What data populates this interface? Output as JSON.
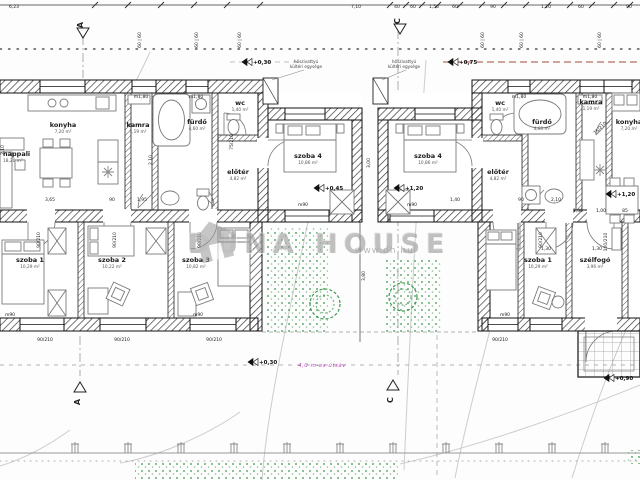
{
  "watermark": {
    "brand": "DUNA HOUSE",
    "url": "www.dh.hu"
  },
  "notes": {
    "road_note": "4,0 m-es útsáv",
    "heat_pump_lines": [
      "hőszivattyú",
      "kültéri egysége"
    ],
    "heat_pump_positions": [
      {
        "x": 306,
        "y": 63
      },
      {
        "x": 404,
        "y": 63
      }
    ]
  },
  "colors": {
    "wall_edge": "#101010",
    "hatch": "#3a3a3a",
    "thin_line": "#777777",
    "dim_text": "#222222",
    "green": "#3f9a4f",
    "magenta": "#c04ac0",
    "red_dash": "#b4705f",
    "watermark_gray": "#9b9b9b"
  },
  "rooms": [
    {
      "label": "nappali",
      "area": "18,20 m²",
      "x": 3,
      "y": 156,
      "anchor": "start"
    },
    {
      "label": "konyha",
      "area": "7,20 m²",
      "x": 63,
      "y": 127
    },
    {
      "label": "kamra",
      "area": "1,19 m²",
      "x": 138,
      "y": 127
    },
    {
      "label": "fürdő",
      "area": "4,60 m²",
      "x": 197,
      "y": 124
    },
    {
      "label": "wc",
      "area": "1,40 m²",
      "x": 240,
      "y": 105
    },
    {
      "label": "előtér",
      "area": "4,82 m²",
      "x": 238,
      "y": 174
    },
    {
      "label": "szoba 1",
      "area": "10,29 m²",
      "x": 30,
      "y": 262
    },
    {
      "label": "szoba 2",
      "area": "10,22 m²",
      "x": 112,
      "y": 262
    },
    {
      "label": "szoba 3",
      "area": "10,82 m²",
      "x": 196,
      "y": 262
    },
    {
      "label": "szoba 4",
      "area": "10,86 m²",
      "x": 308,
      "y": 158
    },
    {
      "label": "szoba 4",
      "area": "10,86 m²",
      "x": 428,
      "y": 158
    },
    {
      "label": "wc",
      "area": "1,40 m²",
      "x": 500,
      "y": 105
    },
    {
      "label": "fürdő",
      "area": "4,60 m²",
      "x": 542,
      "y": 124
    },
    {
      "label": "kamra",
      "area": "1,19 m²",
      "x": 591,
      "y": 104
    },
    {
      "label": "konyha",
      "area": "7,20 m²",
      "x": 629,
      "y": 124
    },
    {
      "label": "előtér",
      "area": "4,82 m²",
      "x": 498,
      "y": 174
    },
    {
      "label": "szoba 1",
      "area": "10,29 m²",
      "x": 538,
      "y": 262
    },
    {
      "label": "szélfogó",
      "area": "3,96 m²",
      "x": 595,
      "y": 262
    }
  ],
  "levels": [
    {
      "text": "+0,30",
      "x": 252,
      "y": 64
    },
    {
      "text": "+0,75",
      "x": 458,
      "y": 64
    },
    {
      "text": "+0,45",
      "x": 324,
      "y": 190
    },
    {
      "text": "+1,20",
      "x": 404,
      "y": 190
    },
    {
      "text": "+1,20",
      "x": 616,
      "y": 196
    },
    {
      "text": "+0,30",
      "x": 258,
      "y": 364
    },
    {
      "text": "+0,90",
      "x": 614,
      "y": 380
    }
  ],
  "section_markers": [
    {
      "label": "A",
      "x": 83,
      "y": 24,
      "dir": "top"
    },
    {
      "label": "C",
      "x": 400,
      "y": 20,
      "dir": "top"
    },
    {
      "label": "A",
      "x": 80,
      "y": 382,
      "dir": "bottom"
    },
    {
      "label": "C",
      "x": 393,
      "y": 380,
      "dir": "bottom"
    }
  ],
  "dimensions": [
    {
      "text": "6,23",
      "x": 14,
      "y": 8,
      "rot": 0
    },
    {
      "text": "7,10",
      "x": 356,
      "y": 8,
      "rot": 0
    },
    {
      "text": "40",
      "x": 397,
      "y": 8,
      "rot": 0
    },
    {
      "text": "60",
      "x": 413,
      "y": 8,
      "rot": 0
    },
    {
      "text": "1,50",
      "x": 434,
      "y": 8,
      "rot": 0
    },
    {
      "text": "60",
      "x": 455,
      "y": 8,
      "rot": 0
    },
    {
      "text": "90",
      "x": 493,
      "y": 8,
      "rot": 0
    },
    {
      "text": "1,20",
      "x": 546,
      "y": 8,
      "rot": 0
    },
    {
      "text": "60",
      "x": 581,
      "y": 8,
      "rot": 0
    },
    {
      "text": "90",
      "x": 629,
      "y": 8,
      "rot": 0
    },
    {
      "text": "60 | 60",
      "x": 141,
      "y": 40,
      "rot": -90
    },
    {
      "text": "60 | 60",
      "x": 198,
      "y": 40,
      "rot": -90
    },
    {
      "text": "60 | 60",
      "x": 241,
      "y": 40,
      "rot": -90
    },
    {
      "text": "60 | 60",
      "x": 484,
      "y": 40,
      "rot": -90
    },
    {
      "text": "60 | 60",
      "x": 523,
      "y": 40,
      "rot": -90
    },
    {
      "text": "60 | 60",
      "x": 601,
      "y": 40,
      "rot": -90
    },
    {
      "text": "m1,80",
      "x": 141,
      "y": 98,
      "rot": 0
    },
    {
      "text": "m1,80",
      "x": 196,
      "y": 98,
      "rot": 0
    },
    {
      "text": "m1,80",
      "x": 519,
      "y": 98,
      "rot": 0
    },
    {
      "text": "m1,80",
      "x": 590,
      "y": 98,
      "rot": 0
    },
    {
      "text": "3,65",
      "x": 50,
      "y": 201,
      "rot": 0
    },
    {
      "text": "90",
      "x": 112,
      "y": 201,
      "rot": 0
    },
    {
      "text": "1,95",
      "x": 142,
      "y": 201,
      "rot": 0
    },
    {
      "text": "1,40",
      "x": 455,
      "y": 201,
      "rot": 0
    },
    {
      "text": "90",
      "x": 521,
      "y": 201,
      "rot": 0
    },
    {
      "text": "2,10",
      "x": 556,
      "y": 201,
      "rot": 0
    },
    {
      "text": "1,40",
      "x": 578,
      "y": 212,
      "rot": 0
    },
    {
      "text": "1,00",
      "x": 601,
      "y": 212,
      "rot": 0
    },
    {
      "text": "85",
      "x": 625,
      "y": 212,
      "rot": 0
    },
    {
      "text": "m90",
      "x": 303,
      "y": 206,
      "rot": 0
    },
    {
      "text": "m90",
      "x": 412,
      "y": 206,
      "rot": 0
    },
    {
      "text": "m90",
      "x": 10,
      "y": 316,
      "rot": 0
    },
    {
      "text": "m90",
      "x": 198,
      "y": 316,
      "rot": 0
    },
    {
      "text": "m90",
      "x": 505,
      "y": 316,
      "rot": 0
    },
    {
      "text": "3,00",
      "x": 370,
      "y": 163,
      "rot": -90
    },
    {
      "text": "3,80",
      "x": 365,
      "y": 276,
      "rot": -90
    },
    {
      "text": "90/210",
      "x": 40,
      "y": 240,
      "rot": -90
    },
    {
      "text": "90/210",
      "x": 116,
      "y": 240,
      "rot": -90
    },
    {
      "text": "90/210",
      "x": 201,
      "y": 240,
      "rot": -90
    },
    {
      "text": "75/210",
      "x": 233,
      "y": 142,
      "rot": -90
    },
    {
      "text": "75/210",
      "x": 601,
      "y": 129,
      "rot": -45
    },
    {
      "text": "100/210",
      "x": 607,
      "y": 242,
      "rot": -90
    },
    {
      "text": "90/210",
      "x": 542,
      "y": 240,
      "rot": -90
    },
    {
      "text": "1,30",
      "x": 546,
      "y": 250,
      "rot": 0
    },
    {
      "text": "1,30",
      "x": 597,
      "y": 250,
      "rot": 0
    },
    {
      "text": "90/210",
      "x": 45,
      "y": 341,
      "rot": 0
    },
    {
      "text": "90/210",
      "x": 122,
      "y": 341,
      "rot": 0
    },
    {
      "text": "90/210",
      "x": 214,
      "y": 341,
      "rot": 0
    },
    {
      "text": "90/210",
      "x": 500,
      "y": 341,
      "rot": 0
    },
    {
      "text": "2,10",
      "x": 152,
      "y": 160,
      "rot": -90
    },
    {
      "text": "2,10",
      "x": 4,
      "y": 150,
      "rot": -90
    }
  ]
}
